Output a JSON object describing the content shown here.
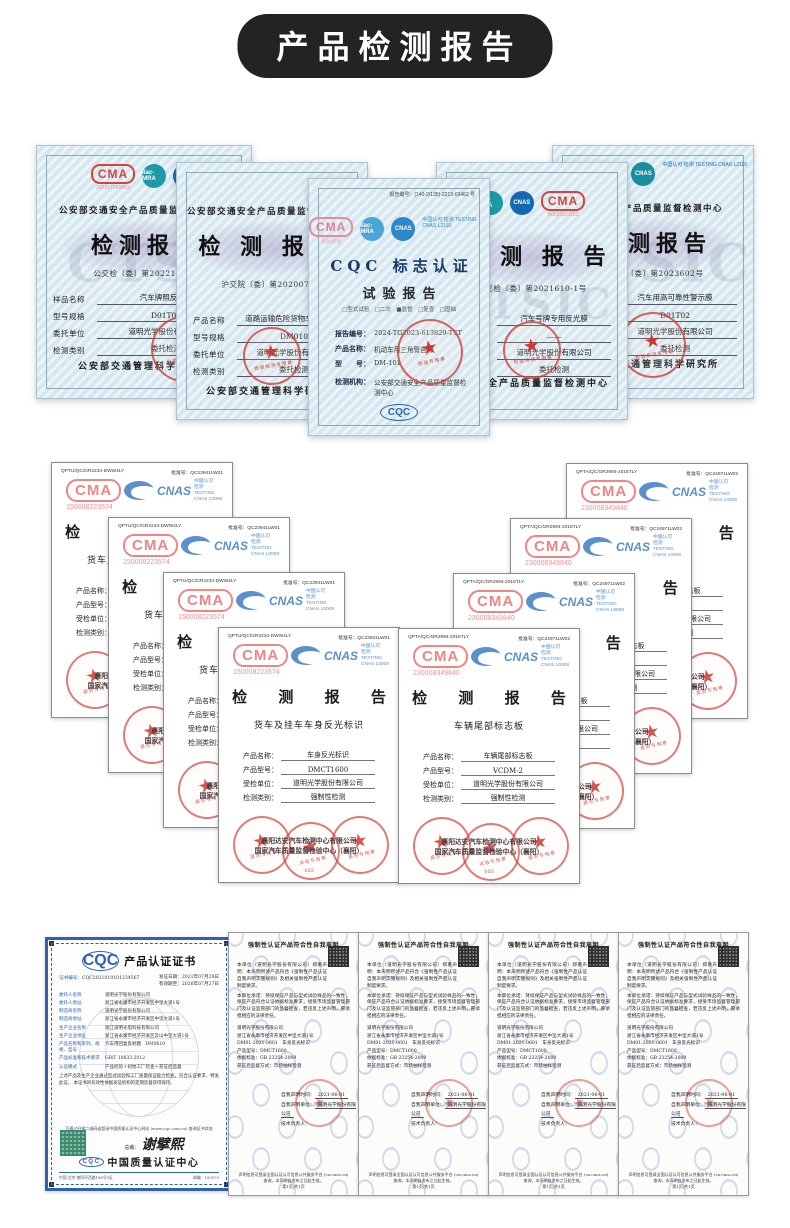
{
  "page": {
    "title": "产品检测报告"
  },
  "row1": {
    "certs": [
      {
        "header": "公安部交通安全产品质量监督检测中心",
        "cma": "CMA",
        "cma_sub": "2022170F0003",
        "ilac": "ilac-MRA",
        "cnas": "CNAS",
        "title": "检测报告",
        "no": "公交检〔委〕第2022141号",
        "fields": [
          [
            "样品名称",
            "汽车牌照反光膜"
          ],
          [
            "型号规格",
            "D01T01"
          ],
          [
            "委托单位",
            "道明光学股份有限公司"
          ],
          [
            "检测类别",
            "委托检测"
          ]
        ],
        "footer": "公安部交通管理科学研究所",
        "seal_text": "检验检测专用章",
        "watermark": "CTSI"
      },
      {
        "header": "公安部交通安全产品质量监督检测中心",
        "title": "检 测 报 告",
        "no": "沪交院〔委〕第2020076号",
        "fields": [
          [
            "产品名称",
            "道路运输危险货物车辆标志牌"
          ],
          [
            "型号规格",
            "DM010"
          ],
          [
            "委托单位",
            "道明光学股份有限公司"
          ],
          [
            "检测类别",
            "委托检测"
          ]
        ],
        "footer": "公安部交通管理科学研究所",
        "seal_text": "检验检测专用章"
      },
      {
        "code": "报告编号：(140-2/135)-2213-03462 号",
        "cma": "CMA",
        "cma_sub": "检验检测",
        "ilac": "ilac-MRA",
        "cnas": "CNAS",
        "cnas_lines": "中国认可 检测 TESTING CNAS L2110",
        "title1": "CQC 标志认证",
        "title2": "试验报告",
        "checks": "□型式试验　□二次　■监督　□复查　□国抽",
        "fields": [
          [
            "报告编号：",
            "2024-TG2023-613829-TST"
          ],
          [
            "产品名称：",
            "机动车用三角警告牌"
          ],
          [
            "型　　号：",
            "DM-101"
          ],
          [
            "检测机构：",
            "公安部交通安全产品质量监督检测中心"
          ]
        ],
        "org2": "公安部交通安全产品质量监督检测中心",
        "seal_text": "检验专用章",
        "cqc": "CQC"
      },
      {
        "cma": "CMA",
        "cma_sub": "N0020021152",
        "ilac": "ilac-MRA",
        "cnas": "CNAS",
        "title": "检 测 报 告",
        "no": "公交检〔委〕第2021610-1号",
        "fields": [
          [
            "样品名称",
            "汽车号牌专用反光膜"
          ],
          [
            "型号规格",
            "——"
          ],
          [
            "委托单位",
            "道明光学股份有限公司"
          ],
          [
            "检测类别",
            "委托检测"
          ]
        ],
        "footer": "交通安全产品质量监督检测中心",
        "seal_text": "检验检测专用章"
      },
      {
        "header": "交通安全产品质量监督检测中心",
        "ilac": "ilac-MRA",
        "cnas": "CNAS",
        "cnas_lines": "中国认可 检测 TESTING CNAS L2110",
        "title": "检测报告",
        "no": "公交检〔委〕第2023602号",
        "fields": [
          [
            "样品名称",
            "汽车用高可靠性警示膜"
          ],
          [
            "型号规格",
            "D01T02"
          ],
          [
            "委托单位",
            "道明光学股份有限公司"
          ],
          [
            "检测类别",
            "委托检测"
          ]
        ],
        "footer": "公安部交通管理科学研究所",
        "seal_text": "检验检测专用章",
        "watermark": "CTSIC"
      }
    ]
  },
  "row2": {
    "left": {
      "code_left": "QPTU/QC/GR2234-DWW4LY",
      "code_right": "批准号：QC23941LW01",
      "cma": "CMA",
      "cma_no": "150008223574",
      "cnas": "CNAS",
      "cnas_l1": "中国认可",
      "cnas_l2": "检测",
      "cnas_l3": "TESTING",
      "cnas_l4": "CNAS L0008",
      "title": "检 测 报 告",
      "subtitle": "货车及挂车车身反光标识",
      "fields": [
        [
          "产品名称：",
          "车身反光标识"
        ],
        [
          "产品型号：",
          "DMCT1600"
        ],
        [
          "受检单位：",
          "道明光学股份有限公司"
        ],
        [
          "检测类别：",
          "强制性检测"
        ]
      ],
      "company1": "襄阳达安汽车检测中心有限公司",
      "company2": "国家汽车质量监督检验中心（襄阳）",
      "seal1": "报告专用章",
      "seal2": "试验专用章",
      "seal3": "报告专用章",
      "seal_sub": "103"
    },
    "right": {
      "code_left": "QPTA/QC/GR2994-2016TLY",
      "code_right": "批准号：QC24971LW02",
      "cma": "CMA",
      "cma_no": "230008349840",
      "cnas": "CNAS",
      "cnas_l1": "中国认可",
      "cnas_l2": "检测",
      "cnas_l3": "TESTING",
      "cnas_l4": "CNAS L0008",
      "title": "检 测 报 告",
      "subtitle": "车辆尾部标志板",
      "fields": [
        [
          "产品名称：",
          "车辆尾部标志板"
        ],
        [
          "产品型号：",
          "VCDM-2"
        ],
        [
          "受检单位：",
          "道明光学股份有限公司"
        ],
        [
          "检测类别：",
          "强制性检测"
        ]
      ],
      "company1": "襄阳达安汽车检测中心有限公司",
      "company2": "国家汽车质量监督检验中心（襄阳）",
      "seal1": "报告专用章",
      "seal2": "试验专用章",
      "seal3": "报告专用章",
      "seal_sub": "103"
    }
  },
  "row3": {
    "cqc": {
      "logo": "CQC",
      "title": "产品认证证书",
      "no_label": "证书编号：",
      "no": "CQC2021010101234567",
      "date1": "发证日期：2021年07月28日",
      "date2": "有效期至：2026年07月27日",
      "rows": [
        [
          "委托人名称",
          "道明光学股份有限公司"
        ],
        [
          "委托人地址",
          "浙江省永康市经济开发区中坚大道1号"
        ],
        [
          "制造商名称",
          "道明光学股份有限公司"
        ],
        [
          "制造商地址",
          "浙江省永康市经济开发区中坚大道1号"
        ],
        [
          "生产企业名称",
          "浙江道明光电科技有限公司"
        ],
        [
          "生产企业地址",
          "浙江省永康市经济开发区云山中坚大道1号"
        ],
        [
          "产品名称和系列、规格、型号",
          "汽车用回复反射膜　DM9610"
        ],
        [
          "产品标准和技术要求",
          "GB/T 18833-2012"
        ],
        [
          "认证模式",
          "产品检验＋初始工厂检查＋获证后监督"
        ]
      ],
      "para1": "上述产品及生产企业通过型式试验和工厂质量保证能力检查，符合认证要求，特发此证。",
      "para2": "本证书的有效性依据发证机构的定期监督获得保持。",
      "note": "可通过扫描二维码或登录中国质量认证中心网站 (www.cqc.com.cn) 查询证书状态",
      "sign_label": "总裁：",
      "sign": "谢擘熙",
      "org": "中国质量认证中心",
      "foot_left": "中国·北京·南四环西路188号9区",
      "foot_right": "邮编：100070"
    },
    "decl": {
      "title": "强制性认证产品符合性自我声明",
      "para1": "本单位（道明光学股份有限公司）郑重声明：本声明所述产品符合《强制性产品认证自我声明实施规则》及相关强制性产品认证制度要求。",
      "para2": "本单位承诺：持续保证产品与型式试验样品的一致性，保证产品符合认证依据标准要求，接受市场监督管理部门及认证监管部门的监督检查，若违反上述声明，愿承担相应的法律责任。",
      "info1": "道明光学股份有限公司",
      "info2": "浙江省永康市经济开发区中坚大道1号",
      "info3": "DM01-2021-0601　车身反光标识",
      "info4": "产品型号：DMCT1600",
      "info5": "依据标准：GB 23254-2009",
      "info6": "获证后监督方式：市场抽样检测",
      "sig1_label": "自我声明时间：",
      "sig1": "2021-06-01",
      "sig2_label": "自我声明单位：",
      "sig2": "道明光学股份有限公司",
      "sig3": "技术负责人：",
      "footer1": "声明信息可登录全国认证认可信息公共服务平台 (cx.cnca.cn) 查询，本声明自发布之日起生效。",
      "footer2": "第1页/共1页"
    }
  }
}
